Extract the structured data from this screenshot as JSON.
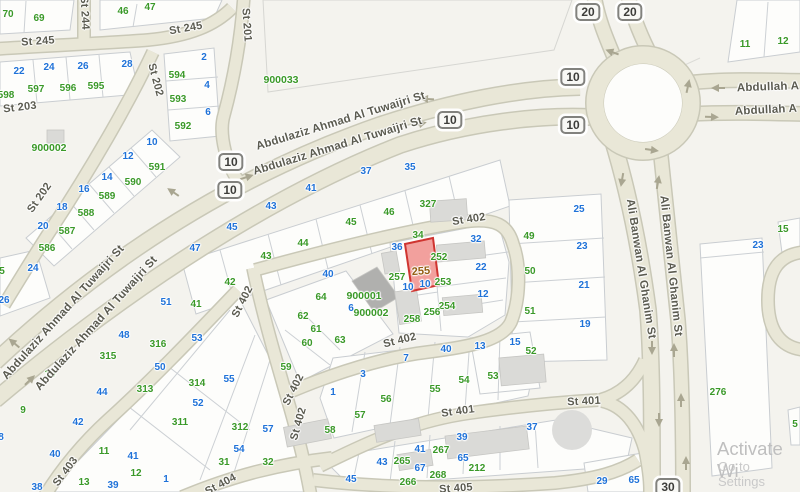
{
  "map": {
    "colors": {
      "green": "#3a9928",
      "blue": "#1f72d8",
      "road_fill": "#e9e7d7",
      "road_casing": "#c9c8b7",
      "selected_fill": "#f2a09d",
      "selected_border": "#cf3430",
      "selected_text": "#935c10"
    },
    "selected_parcel": {
      "label": "255"
    },
    "green_labels": [
      [
        "70",
        8,
        15
      ],
      [
        "69",
        39,
        19
      ],
      [
        "46",
        123,
        12
      ],
      [
        "47",
        150,
        8
      ],
      [
        "598",
        6,
        96
      ],
      [
        "597",
        36,
        90
      ],
      [
        "596",
        68,
        89
      ],
      [
        "595",
        96,
        87
      ],
      [
        "594",
        177,
        76
      ],
      [
        "593",
        178,
        100
      ],
      [
        "592",
        183,
        127
      ],
      [
        "591",
        157,
        168
      ],
      [
        "590",
        133,
        183
      ],
      [
        "589",
        107,
        197
      ],
      [
        "588",
        86,
        214
      ],
      [
        "587",
        67,
        232
      ],
      [
        "586",
        47,
        249
      ],
      [
        "5",
        2,
        272
      ],
      [
        "41",
        196,
        305
      ],
      [
        "42",
        230,
        283
      ],
      [
        "43",
        266,
        257
      ],
      [
        "44",
        303,
        244
      ],
      [
        "45",
        351,
        223
      ],
      [
        "46",
        389,
        213
      ],
      [
        "327",
        428,
        205
      ],
      [
        "34",
        418,
        236
      ],
      [
        "252",
        439,
        258
      ],
      [
        "253",
        443,
        283
      ],
      [
        "254",
        447,
        307
      ],
      [
        "256",
        432,
        313
      ],
      [
        "257",
        397,
        278
      ],
      [
        "258",
        412,
        320
      ],
      [
        "49",
        529,
        237
      ],
      [
        "50",
        530,
        272
      ],
      [
        "51",
        530,
        312
      ],
      [
        "52",
        531,
        352
      ],
      [
        "53",
        493,
        377
      ],
      [
        "64",
        321,
        298
      ],
      [
        "62",
        303,
        317
      ],
      [
        "61",
        316,
        330
      ],
      [
        "63",
        340,
        341
      ],
      [
        "60",
        307,
        344
      ],
      [
        "59",
        286,
        368
      ],
      [
        "316",
        158,
        345
      ],
      [
        "315",
        108,
        357
      ],
      [
        "313",
        145,
        390
      ],
      [
        "314",
        197,
        384
      ],
      [
        "311",
        180,
        423
      ],
      [
        "312",
        240,
        428
      ],
      [
        "31",
        224,
        463
      ],
      [
        "32",
        268,
        463
      ],
      [
        "10",
        50,
        375
      ],
      [
        "9",
        23,
        411
      ],
      [
        "11",
        104,
        452
      ],
      [
        "12",
        136,
        474
      ],
      [
        "13",
        84,
        483
      ],
      [
        "54",
        464,
        381
      ],
      [
        "55",
        435,
        390
      ],
      [
        "56",
        386,
        400
      ],
      [
        "57",
        360,
        416
      ],
      [
        "58",
        330,
        431
      ],
      [
        "265",
        402,
        462
      ],
      [
        "266",
        408,
        483
      ],
      [
        "267",
        441,
        451
      ],
      [
        "268",
        438,
        476
      ],
      [
        "212",
        477,
        469
      ],
      [
        "276",
        718,
        393
      ],
      [
        "15",
        783,
        230
      ],
      [
        "11",
        745,
        45
      ],
      [
        "12",
        783,
        42
      ],
      [
        "5",
        795,
        425
      ]
    ],
    "code_labels": [
      [
        "900033",
        281,
        80
      ],
      [
        "900002",
        49,
        148
      ],
      [
        "900001",
        364,
        296
      ],
      [
        "900002",
        371,
        313
      ]
    ],
    "blue_labels": [
      [
        "22",
        19,
        72
      ],
      [
        "24",
        49,
        68
      ],
      [
        "26",
        83,
        67
      ],
      [
        "28",
        127,
        65
      ],
      [
        "2",
        204,
        58
      ],
      [
        "4",
        207,
        86
      ],
      [
        "6",
        208,
        113
      ],
      [
        "10",
        152,
        143
      ],
      [
        "12",
        128,
        157
      ],
      [
        "14",
        107,
        178
      ],
      [
        "16",
        84,
        190
      ],
      [
        "18",
        62,
        208
      ],
      [
        "20",
        43,
        227
      ],
      [
        "24",
        33,
        269
      ],
      [
        "26",
        4,
        301
      ],
      [
        "47",
        195,
        249
      ],
      [
        "45",
        232,
        228
      ],
      [
        "43",
        271,
        207
      ],
      [
        "41",
        311,
        189
      ],
      [
        "37",
        366,
        172
      ],
      [
        "35",
        410,
        168
      ],
      [
        "36",
        397,
        248
      ],
      [
        "32",
        476,
        240
      ],
      [
        "22",
        481,
        268
      ],
      [
        "12",
        483,
        295
      ],
      [
        "10",
        408,
        288
      ],
      [
        "10",
        425,
        285
      ],
      [
        "40",
        328,
        275
      ],
      [
        "6",
        351,
        309
      ],
      [
        "25",
        579,
        210
      ],
      [
        "23",
        582,
        247
      ],
      [
        "21",
        584,
        286
      ],
      [
        "19",
        585,
        325
      ],
      [
        "48",
        124,
        336
      ],
      [
        "51",
        166,
        303
      ],
      [
        "53",
        197,
        339
      ],
      [
        "50",
        160,
        368
      ],
      [
        "44",
        102,
        393
      ],
      [
        "42",
        78,
        423
      ],
      [
        "40",
        55,
        455
      ],
      [
        "38",
        37,
        488
      ],
      [
        "8",
        1,
        438
      ],
      [
        "41",
        133,
        457
      ],
      [
        "39",
        113,
        486
      ],
      [
        "1",
        166,
        480
      ],
      [
        "55",
        229,
        380
      ],
      [
        "52",
        198,
        404
      ],
      [
        "57",
        268,
        430
      ],
      [
        "54",
        239,
        450
      ],
      [
        "3",
        363,
        375
      ],
      [
        "7",
        406,
        359
      ],
      [
        "40",
        446,
        350
      ],
      [
        "13",
        480,
        347
      ],
      [
        "15",
        515,
        343
      ],
      [
        "1",
        333,
        393
      ],
      [
        "37",
        532,
        428
      ],
      [
        "39",
        462,
        438
      ],
      [
        "41",
        420,
        450
      ],
      [
        "43",
        382,
        463
      ],
      [
        "45",
        351,
        480
      ],
      [
        "65",
        463,
        459
      ],
      [
        "67",
        420,
        469
      ],
      [
        "29",
        602,
        482
      ],
      [
        "65",
        634,
        481
      ],
      [
        "23",
        758,
        246
      ]
    ],
    "street_labels": [
      [
        "St 245",
        38,
        42,
        -4,
        0
      ],
      [
        "St 245",
        186,
        29,
        -10,
        0
      ],
      [
        "St 244",
        84,
        13,
        87,
        0
      ],
      [
        "St 201",
        246,
        25,
        86,
        0
      ],
      [
        "St 203",
        20,
        108,
        -7,
        0
      ],
      [
        "St 202",
        155,
        80,
        75,
        0
      ],
      [
        "St 202",
        40,
        198,
        -55,
        0
      ],
      [
        "Abdulaziz Ahmad Al Tuwaijri St",
        341,
        122,
        -17,
        1
      ],
      [
        "Abdulaziz Ahmad Al Tuwaijri St",
        338,
        147,
        -17,
        1
      ],
      [
        "Abdulaziz Ahmad Al Tuwaijri St",
        64,
        313,
        -48,
        1
      ],
      [
        "Abdulaziz Ahmad Al Tuwaijri St",
        97,
        324,
        -48,
        1
      ],
      [
        "St 402",
        469,
        220,
        -9,
        0
      ],
      [
        "St 402",
        400,
        341,
        -14,
        0
      ],
      [
        "St 402",
        243,
        302,
        -63,
        0
      ],
      [
        "St 402",
        294,
        390,
        -63,
        0
      ],
      [
        "St 402",
        299,
        424,
        -74,
        0
      ],
      [
        "St 401",
        458,
        412,
        -8,
        0
      ],
      [
        "St 401",
        584,
        402,
        -3,
        0
      ],
      [
        "St 403",
        66,
        472,
        -53,
        0
      ],
      [
        "St 404",
        221,
        485,
        -28,
        0
      ],
      [
        "St 405",
        456,
        489,
        -4,
        0
      ],
      [
        "Ali Banwan Al Ghanim St",
        640,
        269,
        81,
        1
      ],
      [
        "Ali Banwan Al Ghanim St",
        670,
        266,
        84,
        1
      ],
      [
        "Abdullah A",
        768,
        88,
        -2,
        1
      ],
      [
        "Abdullah A",
        766,
        111,
        -3,
        1
      ]
    ],
    "route_shields": [
      [
        "10",
        231,
        162
      ],
      [
        "10",
        230,
        190
      ],
      [
        "10",
        450,
        120
      ],
      [
        "10",
        573,
        77
      ],
      [
        "10",
        573,
        125
      ],
      [
        "20",
        588,
        12
      ],
      [
        "20",
        630,
        12
      ],
      [
        "30",
        668,
        487
      ]
    ],
    "arrows": [
      [
        427,
        99,
        183
      ],
      [
        173,
        192,
        214
      ],
      [
        14,
        343,
        220
      ],
      [
        420,
        124,
        -14
      ],
      [
        247,
        177,
        -18
      ],
      [
        30,
        380,
        -44
      ],
      [
        612,
        52,
        200
      ],
      [
        688,
        86,
        -78
      ],
      [
        652,
        150,
        8
      ],
      [
        718,
        88,
        180
      ],
      [
        712,
        117,
        2
      ],
      [
        622,
        180,
        100
      ],
      [
        658,
        182,
        -80
      ],
      [
        652,
        348,
        90
      ],
      [
        659,
        420,
        90
      ],
      [
        674,
        350,
        -90
      ],
      [
        681,
        400,
        -90
      ],
      [
        686,
        463,
        -90
      ]
    ]
  },
  "watermark": {
    "line1": "Activate Wi",
    "line2": "Go to Settings"
  }
}
